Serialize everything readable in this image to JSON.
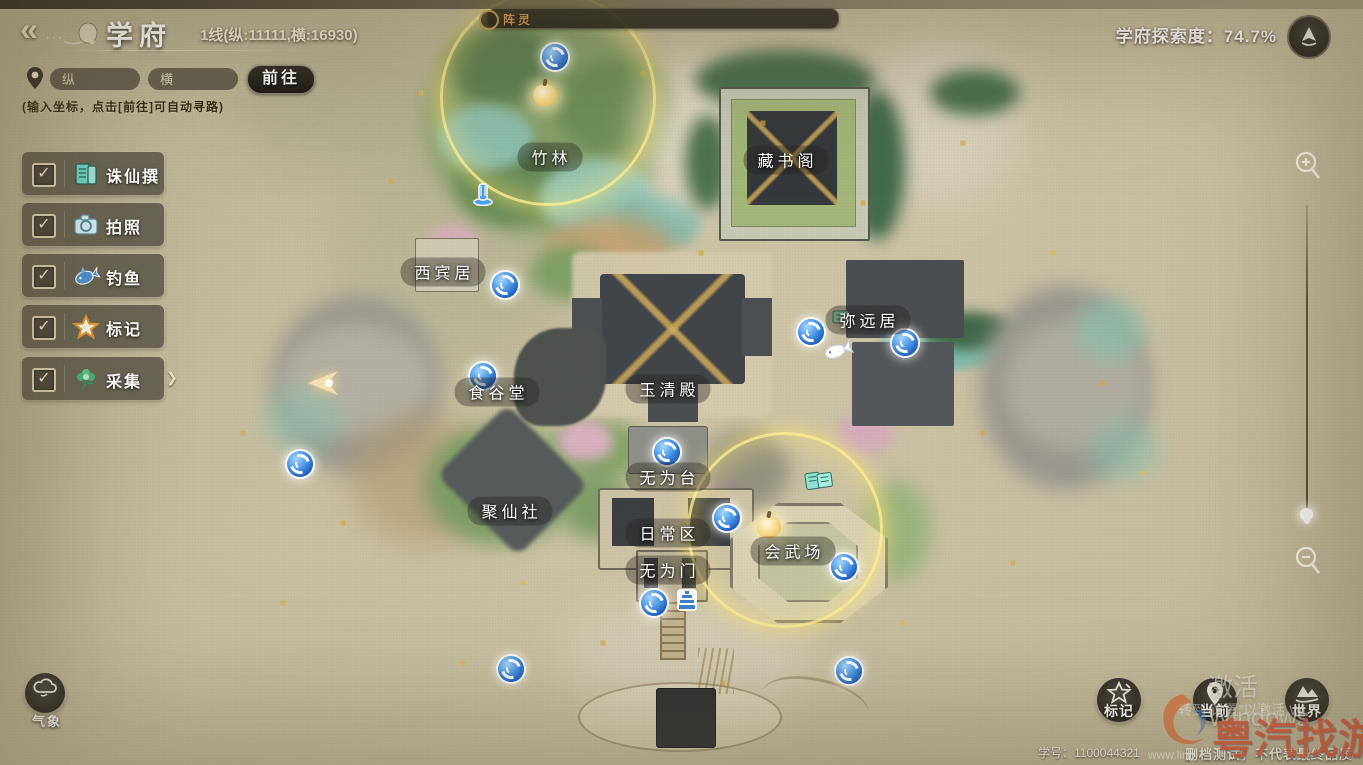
{
  "header": {
    "back_glyph": "«",
    "back_dots": "···",
    "title": "学府",
    "line_info": "1线(纵:11111,横:16930)",
    "exploration_label": "学府探索度：",
    "exploration_value": "74.7%"
  },
  "coord_bar": {
    "input_y_placeholder": "纵",
    "input_x_placeholder": "横",
    "go_button": "前往",
    "hint": "(输入坐标，点击[前往]可自动寻路)"
  },
  "spirit_bar": {
    "label": "阵灵"
  },
  "ui": {
    "check_glyph": "✓",
    "submenu_arrow": "❯"
  },
  "sidebar": {
    "items": [
      {
        "label": "诛仙撰",
        "icon": "zhuxian-book-icon",
        "checked": true
      },
      {
        "label": "拍照",
        "icon": "camera-icon",
        "checked": true
      },
      {
        "label": "钓鱼",
        "icon": "fish-icon",
        "checked": true
      },
      {
        "label": "标记",
        "icon": "star-icon",
        "checked": true
      },
      {
        "label": "采集",
        "icon": "plant-icon",
        "checked": true,
        "has_submenu": true
      }
    ]
  },
  "map": {
    "labels": [
      {
        "text": "竹林"
      },
      {
        "text": "藏书阁"
      },
      {
        "text": "西宾居"
      },
      {
        "text": "弥远居"
      },
      {
        "text": "玉清殿"
      },
      {
        "text": "食谷堂"
      },
      {
        "text": "无为台"
      },
      {
        "text": "聚仙社"
      },
      {
        "text": "日常区"
      },
      {
        "text": "会武场"
      },
      {
        "text": "无为门"
      }
    ]
  },
  "bottom_left": {
    "weather_label": "气象"
  },
  "bottom_right": {
    "buttons": [
      {
        "label": "标记",
        "icon": "mark-star-icon"
      },
      {
        "label": "当前",
        "icon": "current-pin-icon"
      },
      {
        "label": "世界",
        "icon": "world-mountain-icon"
      }
    ]
  },
  "footer": {
    "account_label": "学号：",
    "account_number": "1100044321",
    "account_line": "学号：1100044321",
    "test_notice": "删档测试，不代表最终品质"
  },
  "watermarks": {
    "activate_line1": "激活 Windows",
    "activate_line2": "转到“设置”以激活 Wi",
    "site_name": "粤汽找游戏",
    "site_url": "www.ling"
  },
  "icons": {
    "back-icon": "«",
    "location-pin-icon": "teardrop pin",
    "checkbox": "✓",
    "zhuxian-book-icon": "teal scroll",
    "camera-icon": "camera",
    "fish-icon": "fish",
    "star-icon": "orange star",
    "plant-icon": "green flower",
    "submenu-arrow-icon": "❯",
    "compass-badge-icon": "mountain in circle",
    "zoom-in-icon": "magnifier plus",
    "zoom-out-icon": "magnifier minus",
    "teleport-portal-icon": "blue vortex",
    "collect-peach-icon": "glowing peach",
    "player-arrow-icon": "gold arrow",
    "fountain-icon": "blue fountain",
    "fishing-spot-icon": "white fish",
    "pagoda-icon": "blue pagoda",
    "scroll-marker-icon": "teal scroll",
    "book-marker-icon": "green book",
    "weather-cloud-icon": "cloud",
    "mark-star-icon": "star",
    "current-pin-icon": "pin",
    "world-mountain-icon": "mountain"
  },
  "colors": {
    "parchment": "#c9c0a2",
    "portal_blue": "#2f7fd8",
    "ring_yellow": "#ffe878",
    "accent_gold": "#d89a4e",
    "panel_dark": "#23211d",
    "label_pill": "rgba(36,34,28,0.38)"
  }
}
